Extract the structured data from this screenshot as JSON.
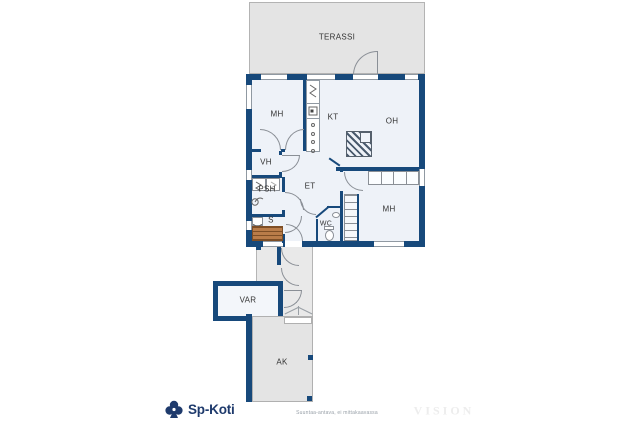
{
  "floorplan": {
    "rooms": {
      "terassi": "TERASSI",
      "mh_top": "MH",
      "kt": "KT",
      "oh": "OH",
      "vh": "VH",
      "psh": "PSH",
      "sauna": "S",
      "et": "ET",
      "wc": "WC",
      "mh_right": "MH",
      "var": "VAR",
      "ak": "AK"
    },
    "colors": {
      "wall": "#17497b",
      "room_fill": "#eef2f8",
      "outdoor_fill": "#e4e4e4",
      "sauna_bench_wood": "#b97c49",
      "fixture_line": "#8a8f96",
      "brand_navy": "#1e3a6c"
    }
  },
  "footer": {
    "brand": "Sp-Koti",
    "disclaimer": "Suuntaa-antava, ei mittakaavassa",
    "watermark": "VISION"
  }
}
